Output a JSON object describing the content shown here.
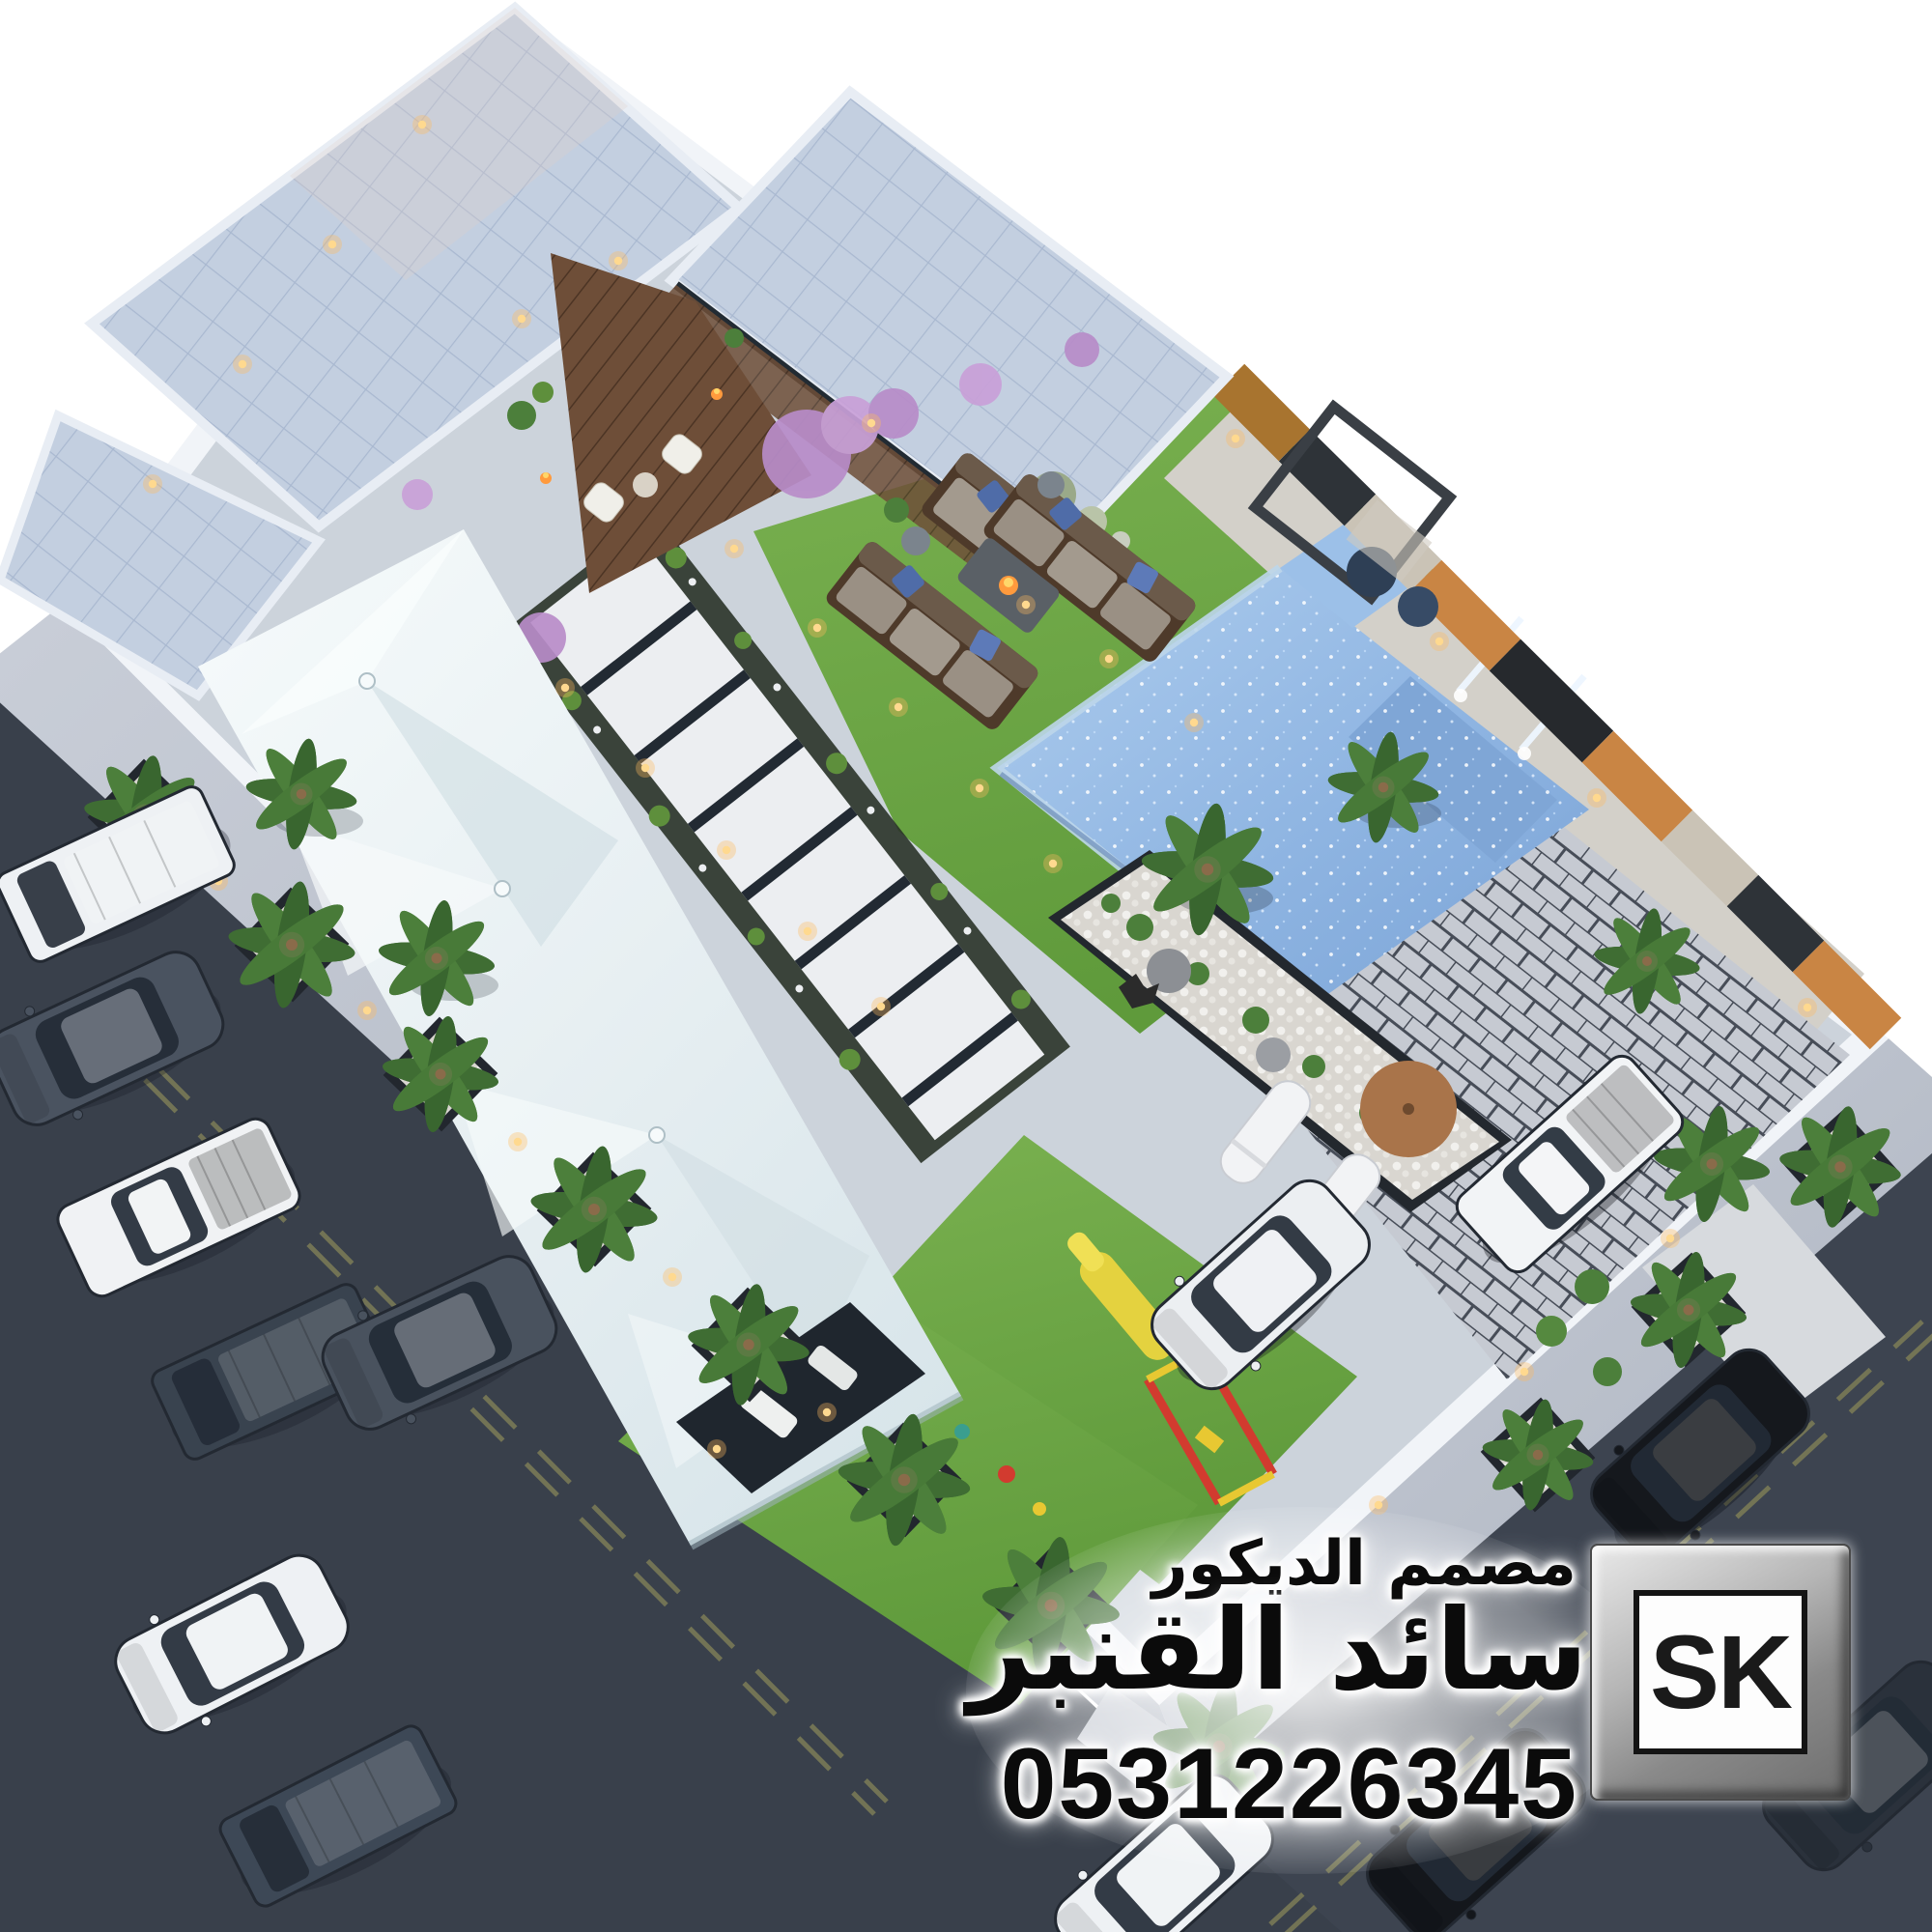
{
  "watermark": {
    "line1": "مصمم الديكور",
    "line2": "سائد القنبر",
    "phone": "0531226345",
    "logo_text": "SK"
  },
  "palette": {
    "background": "#ffffff",
    "asphalt": "#3d4450",
    "sidewalk": "#b9bfc9",
    "perimeter_wall": "#f1f4f8",
    "interior_paving": "#ccd3db",
    "grass": "#6fa845",
    "roof_tiles": "#c3cfe0",
    "wood_deck": "#6e4e38",
    "tent_canvas": "#e9f1f3",
    "pool_water": "#8fb5e2",
    "feature_wood": "#c98544",
    "marble_path": "#eceef1",
    "flowers": "#b88cc9",
    "warm_light": "#ffc97e",
    "playground_red": "#d23b2f",
    "playground_yellow": "#e8c832"
  },
  "scene_objects": [
    "villa-building",
    "tiled-roofs",
    "wood-deck-patio",
    "garden-lawn",
    "swimming-pool",
    "water-feature-wall",
    "majlis-tent",
    "kids-playground",
    "marble-stepping-path",
    "paver-patio",
    "raised-planter",
    "perimeter-wall",
    "sidewalk",
    "street",
    "parked-cars",
    "palm-trees",
    "outdoor-sofas",
    "fire-pit-table",
    "pergola-swing",
    "sun-loungers",
    "patio-umbrella"
  ]
}
